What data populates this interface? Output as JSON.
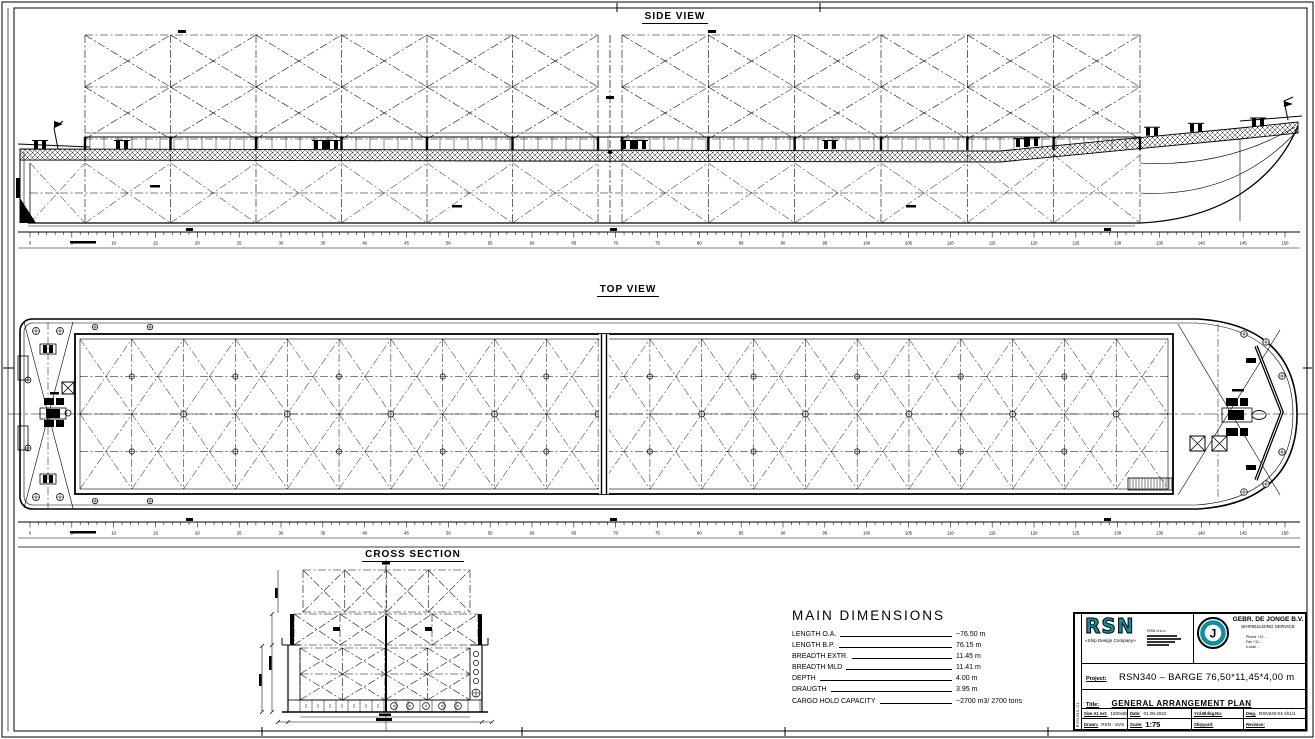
{
  "sheet": {
    "background": "#ffffff",
    "line_color": "#000000",
    "accent_color": "#0e8e9f"
  },
  "labels": {
    "side_view": "SIDE VIEW",
    "top_view": "TOP VIEW",
    "cross_section": "CROSS SECTION"
  },
  "rulers": {
    "min": 0,
    "max": 150,
    "step": 5
  },
  "main_dimensions": {
    "title": "MAIN DIMENSIONS",
    "rows": [
      {
        "label": "LENGTH O.A.",
        "value": "~76.50 m"
      },
      {
        "label": "LENGTH B.P.",
        "value": "76.15 m"
      },
      {
        "label": "BREADTH EXTR.",
        "value": "11.45 m"
      },
      {
        "label": "BREADTH MLD",
        "value": "11.41 m"
      },
      {
        "label": "DEPTH",
        "value": "4.00 m"
      },
      {
        "label": "DRAUGTH",
        "value": "3.95 m"
      },
      {
        "label": "CARGO HOLD CAPACITY",
        "value": "~2700 m3/ 2700 tons"
      }
    ]
  },
  "title_block": {
    "designer": {
      "logo_text": "RSN",
      "tagline": "«Ship Design Company»",
      "info_line": "RSN d.o.o."
    },
    "builder": {
      "name": "GEBR. DE JONGE B.V.",
      "subtitle": "SHIPBUILDING SERVICE",
      "contact": [
        "Phone +31 ...",
        "Fax  +31 ...",
        "e-mail ..."
      ]
    },
    "project": {
      "label": "Project:",
      "value": "RSN340 – BARGE 76,50*11,45*4,00 m"
    },
    "drawing_title": {
      "label": "Title:",
      "value": "GENERAL ARRANGEMENT PLAN"
    },
    "meta": [
      {
        "label": "Size A1 ext:",
        "value": "1000x594"
      },
      {
        "label": "Date:",
        "value": "01.08.2022"
      },
      {
        "label": "Yrd.Bldng.No:",
        "value": ""
      },
      {
        "label": "Dwg.",
        "value": "RSN340-01 sh1/1"
      },
      {
        "label": "Drawn:",
        "value": "RSN - SVS"
      },
      {
        "label": "Scale:",
        "value": "1:75"
      },
      {
        "label": "Shipyard:",
        "value": ""
      },
      {
        "label": "Revision:",
        "value": ""
      }
    ],
    "side_label": "RSN340-01"
  }
}
